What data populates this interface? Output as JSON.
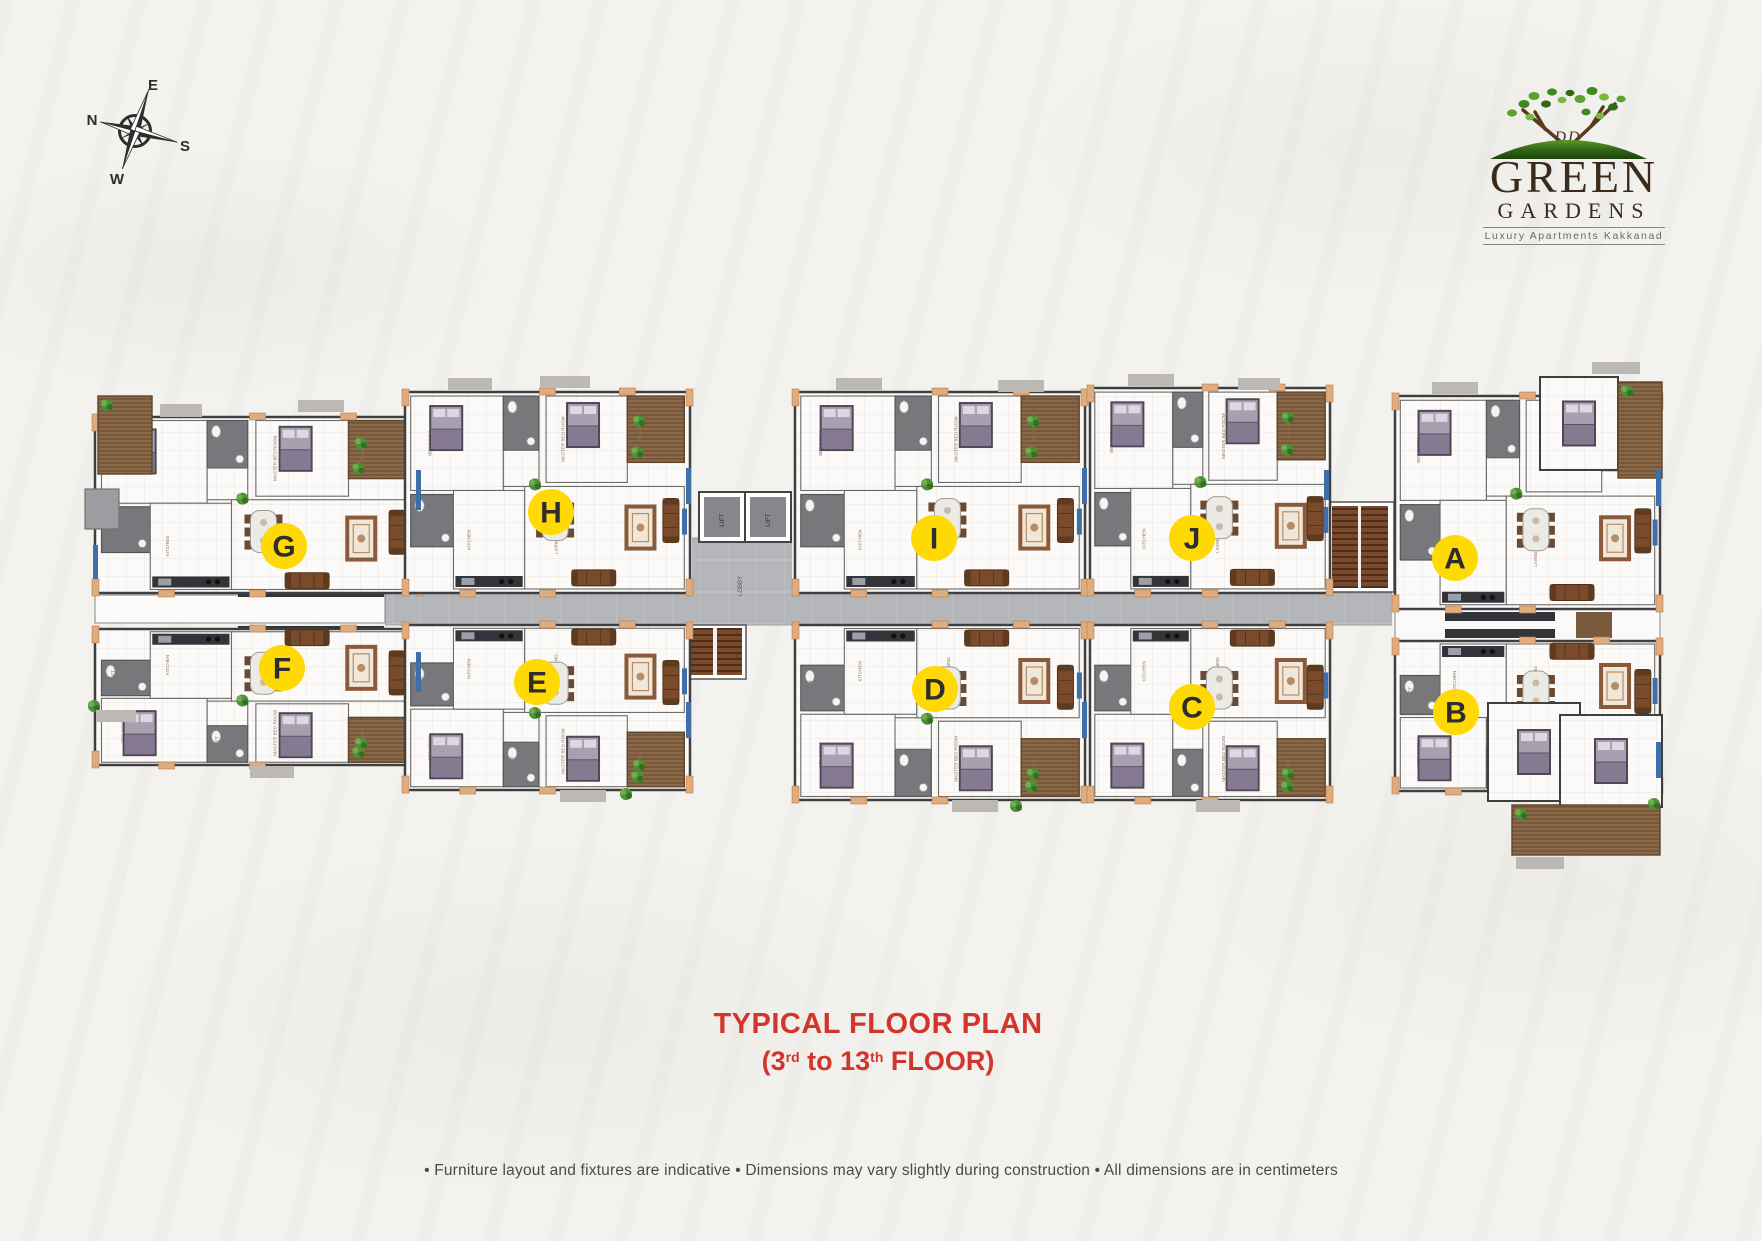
{
  "page": {
    "background": "#f3f2ee"
  },
  "compass": {
    "directions": [
      "N",
      "E",
      "S",
      "W"
    ]
  },
  "logo": {
    "initials": "DD",
    "line1": "GREEN",
    "line2": "GARDENS",
    "tagline": "Luxury Apartments Kakkanad"
  },
  "title": {
    "line1": "TYPICAL FLOOR PLAN",
    "line2_prefix": "(3",
    "line2_sup1": "rd",
    "line2_mid": " to 13",
    "line2_sup2": "th",
    "line2_suffix": " FLOOR)"
  },
  "footnote": "• Furniture layout and fixtures are indicative • Dimensions may vary slightly during construction • All dimensions are in centimeters",
  "core": {
    "lift_label": "LIFT",
    "lobby_label": "LOBBY"
  },
  "room_labels": {
    "bed": "BED ROOM",
    "mbed": "MASTER BED ROOM",
    "kitchen": "KITCHEN",
    "living": "LIVING/DINING",
    "balcony": "BALCONY",
    "toilet": "TOILET"
  },
  "units": [
    {
      "label": "A",
      "x": 1455,
      "y": 558
    },
    {
      "label": "B",
      "x": 1456,
      "y": 712
    },
    {
      "label": "C",
      "x": 1192,
      "y": 707
    },
    {
      "label": "D",
      "x": 935,
      "y": 689
    },
    {
      "label": "E",
      "x": 537,
      "y": 682
    },
    {
      "label": "F",
      "x": 282,
      "y": 668
    },
    {
      "label": "G",
      "x": 284,
      "y": 546
    },
    {
      "label": "H",
      "x": 551,
      "y": 512
    },
    {
      "label": "I",
      "x": 934,
      "y": 538
    },
    {
      "label": "J",
      "x": 1192,
      "y": 538
    }
  ],
  "colors": {
    "marker_yellow": "#FFD903",
    "marker_text": "#2d2d2d",
    "title_red": "#d2352c",
    "corridor_gray": "#b4b6ba",
    "wall_accent_tan": "#e0ab7d",
    "balcony_brown": "#8a6848",
    "sofa_brown": "#7a4b2b",
    "bed_mauve": "#a89fb0",
    "plant_green": "#4e8f3a",
    "logo_green": "#3f7d1e",
    "logo_brown": "#3b2b1d"
  }
}
